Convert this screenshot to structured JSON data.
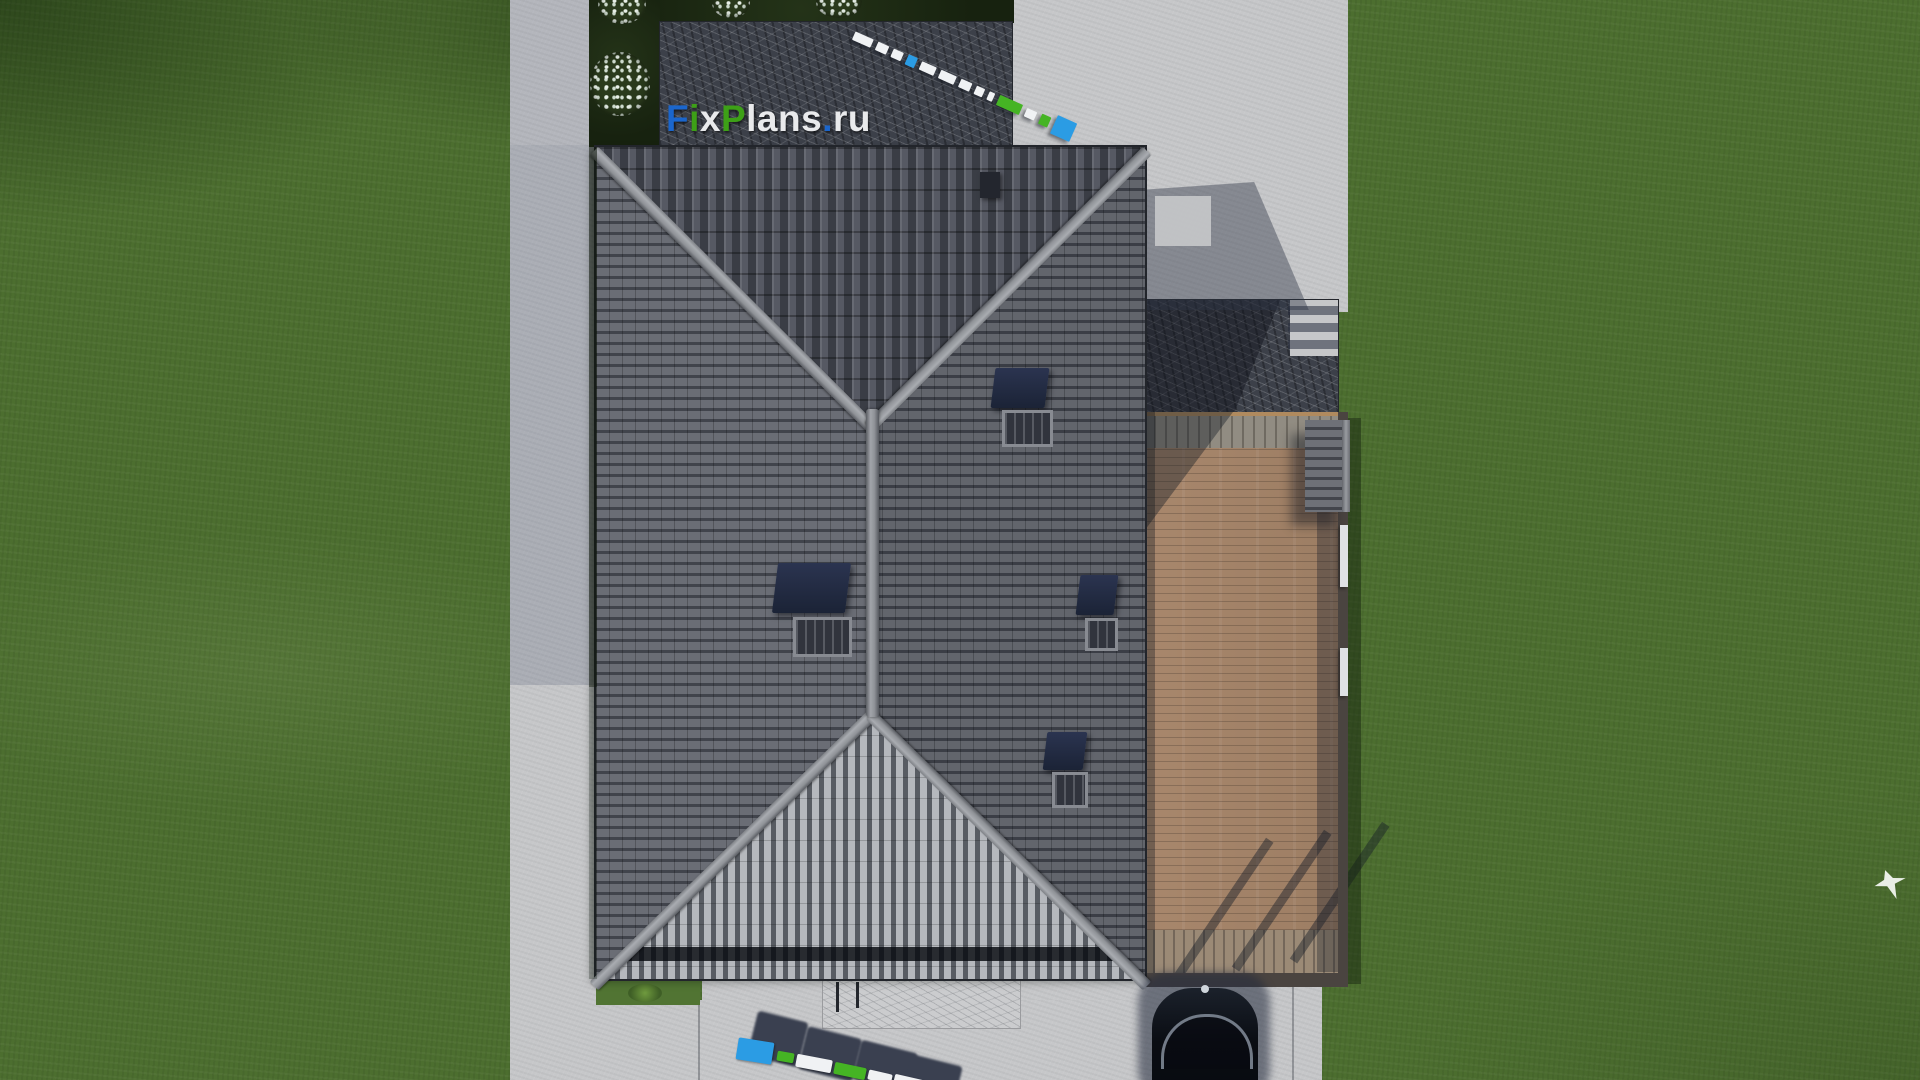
{
  "brand": {
    "watermark_text": "FixPlans.ru",
    "watermark_segments": [
      {
        "text": "F",
        "color": "blue"
      },
      {
        "text": "i",
        "color": "green"
      },
      {
        "text": "x",
        "color": "white"
      },
      {
        "text": "P",
        "color": "green"
      },
      {
        "text": "lans",
        "color": "white"
      },
      {
        "text": ".",
        "color": "blue"
      },
      {
        "text": "ru",
        "color": "white"
      }
    ]
  },
  "sign3d": {
    "top_segments": [
      {
        "color": "white",
        "w": 24,
        "h": 9
      },
      {
        "color": "white",
        "w": 15,
        "h": 9
      },
      {
        "color": "white",
        "w": 13,
        "h": 9
      },
      {
        "color": "blue",
        "w": 12,
        "h": 11
      },
      {
        "color": "white",
        "w": 19,
        "h": 9
      },
      {
        "color": "white",
        "w": 21,
        "h": 9
      },
      {
        "color": "white",
        "w": 15,
        "h": 9
      },
      {
        "color": "white",
        "w": 11,
        "h": 9
      },
      {
        "color": "white",
        "w": 7,
        "h": 9
      },
      {
        "color": "green",
        "w": 30,
        "h": 11
      },
      {
        "color": "white",
        "w": 13,
        "h": 9
      },
      {
        "color": "green",
        "w": 12,
        "h": 11
      },
      {
        "color": "blue",
        "w": 26,
        "h": 20
      }
    ]
  },
  "colors": {
    "grass": "#4c6e2f",
    "concrete": "#c6c7c9",
    "marble_dark": "#3c4049",
    "marble_light": "#cbccce",
    "tile": "#63666e",
    "tile_dark": "#34373e",
    "tile_light": "#b2b5ba",
    "ridge": "#9da0a5",
    "deck": "#a5846a",
    "deck_gray": "#8d8880",
    "fascia": "#4a4440",
    "logo_blue": "#1b66cc",
    "logo_green": "#3da017",
    "logo_white": "#e9eaec",
    "sign_blue": "#2b9ce4",
    "sign_green": "#45b424",
    "sign_white": "#f0f2f4",
    "car": "#0c1018",
    "bird": "#f2f5f0",
    "shadow": "#232a3c"
  }
}
